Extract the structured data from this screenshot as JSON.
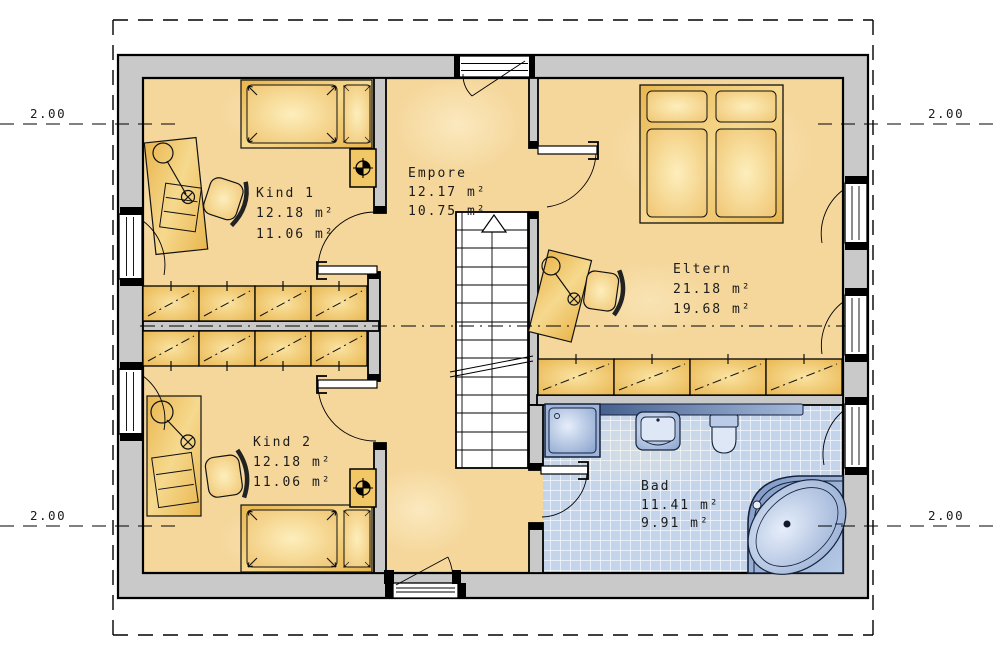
{
  "plan": {
    "rooms": {
      "kind1": {
        "name": "Kind 1",
        "area": "12.18 m²",
        "living_area": "11.06 m²"
      },
      "empore": {
        "name": "Empore",
        "area": "12.17 m²",
        "living_area": "10.75 m²"
      },
      "eltern": {
        "name": "Eltern",
        "area": "21.18 m²",
        "living_area": "19.68 m²"
      },
      "kind2": {
        "name": "Kind 2",
        "area": "12.18 m²",
        "living_area": "11.06 m²"
      },
      "bad": {
        "name": "Bad",
        "area": "11.41 m²",
        "living_area": "9.91 m²"
      }
    },
    "dimension_labels": {
      "top_left": "2.00",
      "top_right": "2.00",
      "bottom_left": "2.00",
      "bottom_right": "2.00"
    },
    "colors": {
      "wall_fill": "#c9c9c9",
      "floor": "#f6d89c",
      "closet": "#eab855",
      "bath_tile": "#c4d5eb",
      "fixture_blue": "#9fb6dc",
      "outline": "#000000"
    }
  }
}
